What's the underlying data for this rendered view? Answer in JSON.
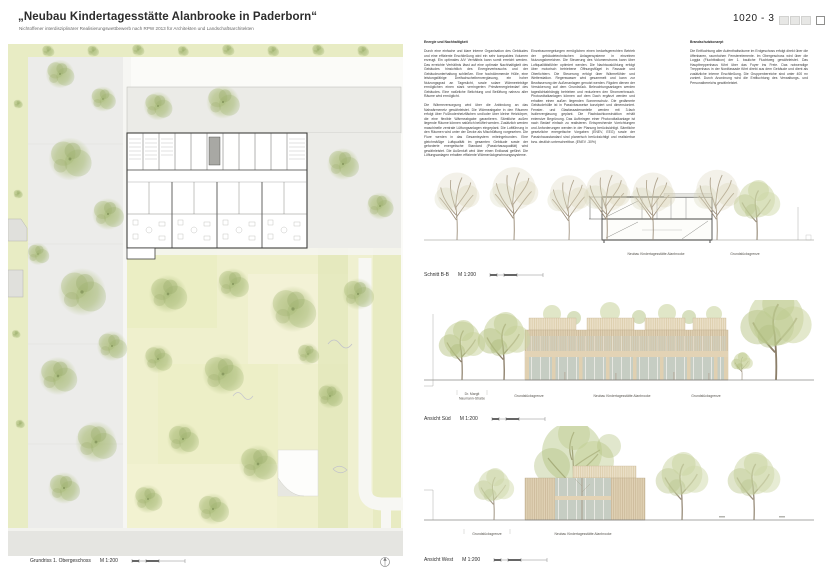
{
  "header": {
    "title": "„Neubau Kindertagesstätte Alanbrooke in Paderborn“",
    "subtitle": "Nichtoffener interdisziplinärer Realisierungswettbewerb nach RPW 2013 für Architekten und Landschaftsarchitekten",
    "entry_number": "1020 - 3"
  },
  "texts": {
    "energy": {
      "heading": "Energie und Nachhaltigkeit",
      "p1": "Durch eine einfache und klare interne Organisation des Gebäudes und eine effiziente Erschließung wird ein sehr kompaktes Volumen erzeugt. Ein optimales A/V Verhältnis kann somit erreicht werden. Das erreichte Verhältnis lässt auf eine optimale Nachhaltigkeit des Gebäudes hinsichtlich des Energieverbrauchs und der Gebäudeunterhaltung schließen. Eine hochdämmende Hülle, eine leistungsfähige Dreifachscheibenverglasung, ein hoher Nutzungsgrad an Tageslicht, sowie solare Wärmeeinträge ermöglichen einen stark verringerten Primärenergiebedarf des Gebäudes. Eine natürliche Belichtung und Belüftung nahezu aller Räume wird ermöglicht.",
      "p2": "Die Wärmeversorgung wird über die Anbindung an das Nahwärmenetz gewährleistet. Die Wärmeabgabe in den Räumen erfolgt über Fußbodenheizflächen und/oder über kleine Heizkörper, die eine flexible Wärmeabgabe garantieren. Sämtliche außen liegende Räume können natürlich belüftet werden. Zusätzlich werden maschinelle zentrale Lüftungsanlagen eingeplant. Die Luftführung in den Räumen wird unter der Decke als Mischlüftung vorgesehen. Die Flure werden in das Gesamtsystem miteingebunden. Eine gleichmäßige Luftqualität im gesamten Gebäude sowie der geforderte energetische Standard (Passivhausqualität) wird gewährleistet. Die Außenluft wird über einen Erdkanal geführt. Die Lüftungsanlagen erhalten effiziente Wärmerückgewinnungssysteme."
    },
    "energy_cont": {
      "p1": "Einzelraumregelungen ermöglichen einen bedarfsgerechten Betrieb der gebäudetechnischen Anlagensysteme in einzelnen Nutzungsbereichen. Die Steuerung des Volumenstroms kann über Luftqualitätsfühler optimiert werden. Die Nachtauskühlung erfolgt über motorisch betriebene Öffnungsflügel in Fassade und Oberlichtern. Die Steuerung erfolgt über Wärmefühler und Wetterstation. Regenwasser wird gesammelt und kann zur Bewässerung der Außenanlagen genutzt werden. Rigolen dienen der Versickerung auf dem Grundstück. Beleuchtungsanlagen werden tageslichtabhängig betrieben und reduzieren den Stromverbrauch. Photovoltaikanlagen können auf dem Dach ergänzt werden und erhalten einen außen liegenden Sonnenschutz. Die gedämmte Gebäudehülle ist in Passivbauweise konzipiert und dimensioniert. Fenster- und Glasfassadenanteile werden mit 3-fach Isolierverglasung geplant. Die Flachdachkonstruktion erhält extensive Begrünung. Das Aufbringen einer Photovoltaikanlage ist nach Bedarf einfach zu realisieren. Entsprechende Vorrichtungen und Anforderungen werden in der Planung berücksichtigt. Sämtliche gesetzliche energetische Vorgaben (ENEV, EEG) sowie der Passivhausstandard sind planerisch berücksichtigt und realisierbar bzw. deutlich unterschreitbar. (ENEV -30%)"
    },
    "fire": {
      "heading": "Brandschutzkonzept",
      "p1": "Die Entfluchtung aller Aufenthaltsräume im Erdgeschoss erfolgt direkt über die öffenbaren, raumhohen Fensterelemente. Im Obergeschoss wird über die Loggia (Fluchtbalkon) der 1. bauliche Fluchtweg gewährleistet. Das Haupttreppenhaus führt über das Foyer ins Freie. Das notwendige Treppenhaus in der Nordfassade führt direkt aus dem Gebäude und dient als zusätzliche interne Erschließung. Die Gruppenbereiche sind unter 400 m² zoniert. Durch Anordnung wird die Entfluchtung des Verwaltungs- und Personalbereichs gewährleistet."
    }
  },
  "drawings": {
    "plan": {
      "caption": "Grundriss 1. Obergeschoss",
      "scale": "M 1:200"
    },
    "section": {
      "caption": "Schnitt B-B",
      "scale": "M 1:200",
      "building_label": "Neubau Kindertagesstätte Alanbrooke",
      "boundary_label": "Grundstücksgrenze"
    },
    "south": {
      "caption": "Ansicht Süd",
      "scale": "M 1:200",
      "street_label_1": "Dr. Margit",
      "street_label_2": "Naumann-Straße",
      "boundary_left_label": "Grundstücksgrenze",
      "building_label": "Neubau Kindertagesstätte Alanbrooke",
      "boundary_right_label": "Grundstücksgrenze"
    },
    "west": {
      "caption": "Ansicht West",
      "scale": "M 1:200",
      "boundary_label": "Grundstücksgrenze",
      "building_label": "Neubau Kindertagesstätte Alanbrooke"
    }
  },
  "palette": {
    "tree_green": "#bfcb90",
    "grass": "#e8ecc4",
    "wood_facade": "#ddcdb0",
    "glass": "#c3cac1",
    "plan_wall": "#3f3f3d"
  }
}
